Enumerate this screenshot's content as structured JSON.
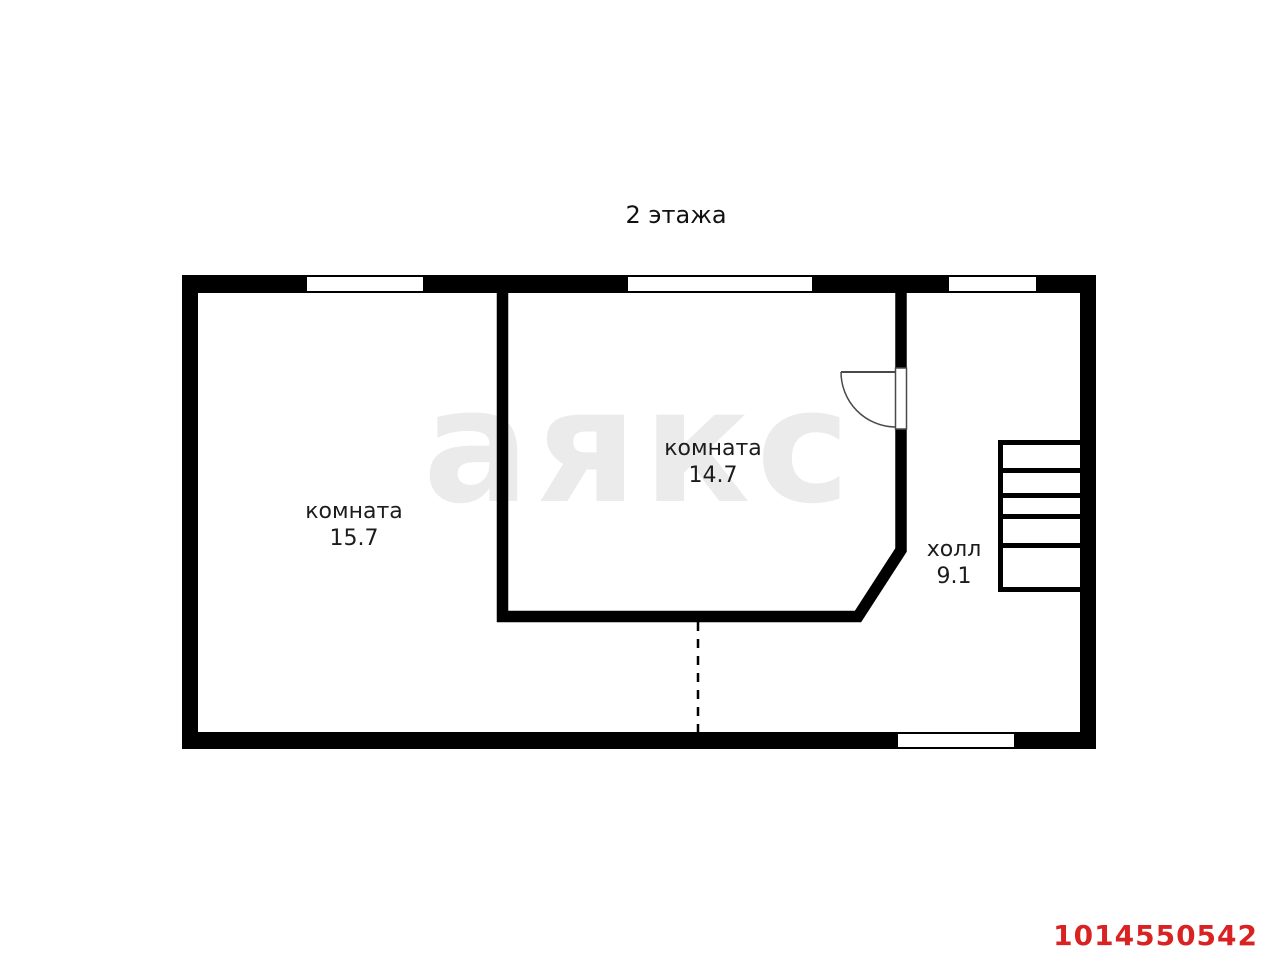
{
  "title": "2 этажа",
  "watermark": {
    "text": "аякс",
    "color": "#ebebeb"
  },
  "rooms": [
    {
      "name": "комната",
      "area": "15.7"
    },
    {
      "name": "комната",
      "area": "14.7"
    },
    {
      "name": "холл",
      "area": "9.1"
    }
  ],
  "listing_id": "1014550542",
  "colors": {
    "wall": "#000000",
    "background": "#ffffff",
    "label_text": "#1c1c1c",
    "listing_id_red": "#d92222",
    "watermark_gray": "#ebebeb"
  }
}
